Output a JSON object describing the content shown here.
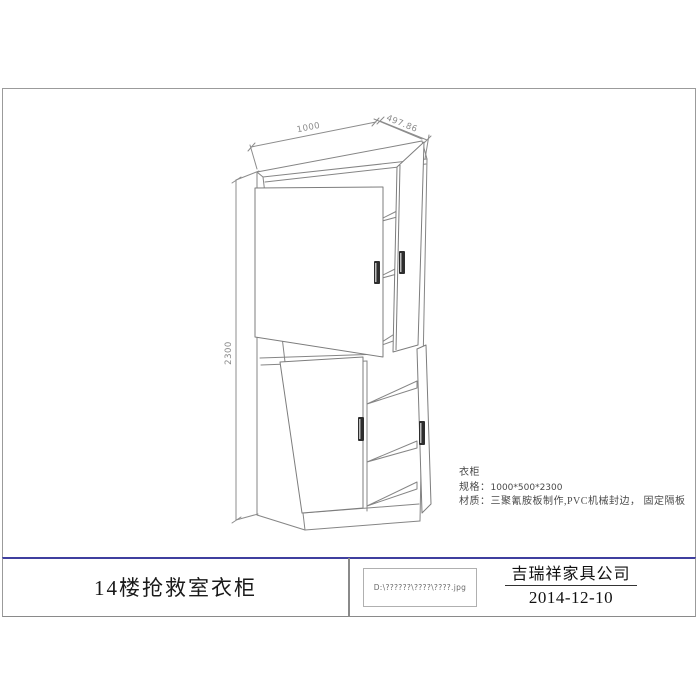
{
  "drawing": {
    "dim_width": "1000",
    "dim_depth": "497.86",
    "dim_height": "2300"
  },
  "annotation": {
    "item": "衣柜",
    "spec_label": "规格：",
    "spec_value": "1000*500*2300",
    "material_label": "材质：",
    "material_value": "三聚氰胺板制作,PVC机械封边， 固定隔板"
  },
  "title_block": {
    "drawing_title": "14楼抢救室衣柜",
    "file_path": "D:\\??????\\????\\????.jpg",
    "company": "吉瑞祥家具公司",
    "date": "2014-12-10"
  },
  "colors": {
    "line": "#858585",
    "dim_line": "#8c8c8c",
    "accent": "#3f3f9f",
    "handle": "#2e2e2e"
  }
}
